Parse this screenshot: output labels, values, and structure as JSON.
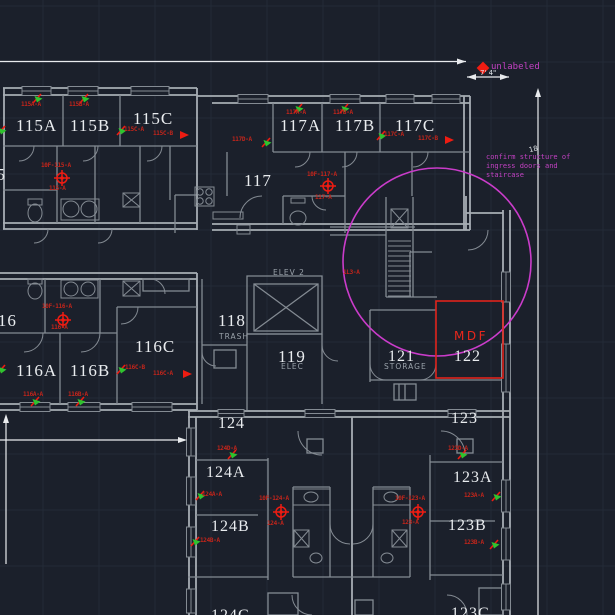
{
  "view": {
    "type": "cad-floor-plan",
    "background": "#1b202b",
    "grid": {
      "color": "#232a37",
      "spacing": 56,
      "offset_x": 43,
      "offset_y": 6
    }
  },
  "colors": {
    "wall": "#848b93",
    "wall_bright": "#a7adb4",
    "dimension": "#e9ebee",
    "room_text": "#e9ecef",
    "device_label_red": "#c3251b",
    "symbol_red": "#ef1c12",
    "highlight_red": "#e0241c",
    "magenta": "#ca3cca",
    "green": "#2fc32f"
  },
  "rooms": [
    {
      "label": "115",
      "x": -22,
      "y": 166,
      "size": 17
    },
    {
      "label": "115A",
      "x": 16,
      "y": 117,
      "size": 17
    },
    {
      "label": "115B",
      "x": 70,
      "y": 117,
      "size": 17
    },
    {
      "label": "115C",
      "x": 133,
      "y": 110,
      "size": 17
    },
    {
      "label": "117A",
      "x": 280,
      "y": 117,
      "size": 17
    },
    {
      "label": "117B",
      "x": 335,
      "y": 117,
      "size": 17
    },
    {
      "label": "117C",
      "x": 395,
      "y": 117,
      "size": 17
    },
    {
      "label": "117",
      "x": 244,
      "y": 172,
      "size": 17
    },
    {
      "label": "116",
      "x": -11,
      "y": 312,
      "size": 17
    },
    {
      "label": "116A",
      "x": 16,
      "y": 362,
      "size": 17
    },
    {
      "label": "116B",
      "x": 70,
      "y": 362,
      "size": 17
    },
    {
      "label": "116C",
      "x": 135,
      "y": 338,
      "size": 17
    },
    {
      "label": "118",
      "x": 218,
      "y": 312,
      "size": 17
    },
    {
      "label": "119",
      "x": 278,
      "y": 348,
      "size": 17
    },
    {
      "label": "121",
      "x": 388,
      "y": 349,
      "size": 16
    },
    {
      "label": "122",
      "x": 454,
      "y": 349,
      "size": 16
    },
    {
      "label": "123",
      "x": 451,
      "y": 411,
      "size": 16
    },
    {
      "label": "123A",
      "x": 453,
      "y": 470,
      "size": 16
    },
    {
      "label": "123B",
      "x": 448,
      "y": 518,
      "size": 16
    },
    {
      "label": "124",
      "x": 218,
      "y": 416,
      "size": 16
    },
    {
      "label": "124A",
      "x": 206,
      "y": 465,
      "size": 16
    },
    {
      "label": "124B",
      "x": 211,
      "y": 519,
      "size": 16
    },
    {
      "label": "124C",
      "x": 211,
      "y": 608,
      "size": 16
    },
    {
      "label": "123C",
      "x": 451,
      "y": 606,
      "size": 16
    }
  ],
  "sub_labels": [
    {
      "label": "TRASH",
      "x": 219,
      "y": 333
    },
    {
      "label": "ELEC",
      "x": 281,
      "y": 363
    },
    {
      "label": "STORAGE",
      "x": 384,
      "y": 363
    },
    {
      "label": "ELEV 2",
      "x": 273,
      "y": 269
    }
  ],
  "device_labels": [
    {
      "label": "115A-A",
      "x": 21,
      "y": 102
    },
    {
      "label": "115B-A",
      "x": 69,
      "y": 102
    },
    {
      "label": "115C-A",
      "x": 124,
      "y": 127
    },
    {
      "label": "115C-B",
      "x": 153,
      "y": 131
    },
    {
      "label": "10F-115-A",
      "x": 41,
      "y": 163
    },
    {
      "label": "115-A",
      "x": 49,
      "y": 186
    },
    {
      "label": "117A-A",
      "x": 286,
      "y": 110
    },
    {
      "label": "117B-A",
      "x": 333,
      "y": 110
    },
    {
      "label": "117D-A",
      "x": 232,
      "y": 137
    },
    {
      "label": "117C-A",
      "x": 384,
      "y": 132
    },
    {
      "label": "117C-B",
      "x": 418,
      "y": 136
    },
    {
      "label": "10F-117-A",
      "x": 307,
      "y": 172
    },
    {
      "label": "117-A",
      "x": 315,
      "y": 195
    },
    {
      "label": "1L3-A",
      "x": 343,
      "y": 270
    },
    {
      "label": "10F-116-A",
      "x": 42,
      "y": 304
    },
    {
      "label": "116-A",
      "x": 51,
      "y": 325
    },
    {
      "label": "116C-B",
      "x": 125,
      "y": 365
    },
    {
      "label": "116C-A",
      "x": 153,
      "y": 371
    },
    {
      "label": "116A-A",
      "x": 23,
      "y": 392
    },
    {
      "label": "116B-A",
      "x": 68,
      "y": 392
    },
    {
      "label": "124D-A",
      "x": 217,
      "y": 446
    },
    {
      "label": "124A-A",
      "x": 202,
      "y": 492
    },
    {
      "label": "10F-124-A",
      "x": 259,
      "y": 496
    },
    {
      "label": "124-A",
      "x": 267,
      "y": 521
    },
    {
      "label": "124B-A",
      "x": 200,
      "y": 538
    },
    {
      "label": "123D-A",
      "x": 448,
      "y": 446
    },
    {
      "label": "123A-A",
      "x": 464,
      "y": 493
    },
    {
      "label": "10F-123-A",
      "x": 395,
      "y": 496
    },
    {
      "label": "123-A",
      "x": 402,
      "y": 520
    },
    {
      "label": "123B-A",
      "x": 464,
      "y": 540
    }
  ],
  "devices": {
    "flags": [
      [
        33,
        94
      ],
      [
        80,
        94
      ],
      [
        117,
        126
      ],
      [
        294,
        104
      ],
      [
        340,
        104
      ],
      [
        262,
        138
      ],
      [
        377,
        131
      ],
      [
        117,
        365
      ],
      [
        31,
        397
      ],
      [
        76,
        397
      ],
      [
        -3,
        126
      ],
      [
        -3,
        365
      ],
      [
        228,
        450
      ],
      [
        196,
        491
      ],
      [
        191,
        537
      ],
      [
        458,
        450
      ],
      [
        492,
        492
      ],
      [
        490,
        540
      ]
    ],
    "arrows": [
      [
        180,
        131
      ],
      [
        445,
        136
      ],
      [
        183,
        370
      ]
    ],
    "targets": [
      [
        62,
        178
      ],
      [
        328,
        186
      ],
      [
        63,
        320
      ],
      [
        281,
        512
      ],
      [
        418,
        512
      ]
    ],
    "diamond": [
      483,
      68
    ]
  },
  "annotations": {
    "unlabeled": "unlabeled",
    "note_line1": "confirm structure of",
    "note_line2": "ingress doors and",
    "note_line3": "staircase",
    "dim_width": "7' 4\"",
    "dim_height": "18'",
    "mdf": "MDF"
  },
  "highlights": {
    "review_circle": {
      "cx": 437,
      "cy": 262,
      "r": 94
    },
    "mdf_rect": {
      "x": 436,
      "y": 301,
      "w": 67,
      "h": 77
    }
  }
}
